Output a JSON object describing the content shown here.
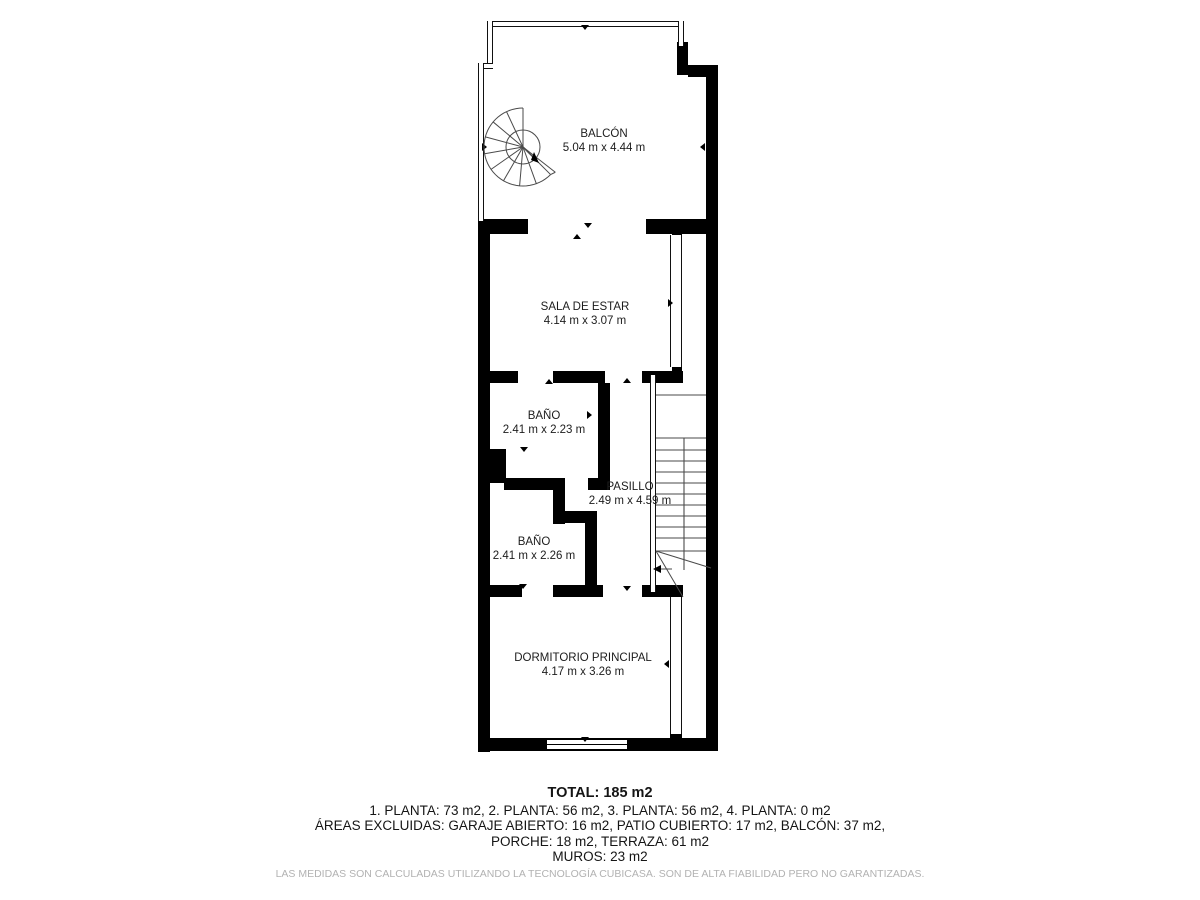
{
  "colors": {
    "wall": "#000000",
    "line": "#4a4a4a",
    "text": "#1c1c1c",
    "muted": "#b2b2b2"
  },
  "rooms": [
    {
      "id": "balcon",
      "name": "BALCÓN",
      "dims": "5.04 m x 4.44 m",
      "x": 604,
      "y": 128
    },
    {
      "id": "sala-de-estar",
      "name": "SALA DE ESTAR",
      "dims": "4.14 m x 3.07 m",
      "x": 585,
      "y": 301
    },
    {
      "id": "bano-1",
      "name": "BAÑO",
      "dims": "2.41 m x 2.23 m",
      "x": 544,
      "y": 410
    },
    {
      "id": "pasillo",
      "name": "PASILLO",
      "dims": "2.49 m x 4.59 m",
      "x": 630,
      "y": 481
    },
    {
      "id": "bano-2",
      "name": "BAÑO",
      "dims": "2.41 m x 2.26 m",
      "x": 534,
      "y": 536
    },
    {
      "id": "dormitorio-principal",
      "name": "DORMITORIO PRINCIPAL",
      "dims": "4.17 m x 3.26 m",
      "x": 583,
      "y": 652
    }
  ],
  "summary": {
    "total": "TOTAL: 185 m2",
    "plantas": "1. PLANTA: 73 m2, 2. PLANTA: 56 m2, 3. PLANTA: 56 m2, 4. PLANTA: 0 m2",
    "excluidas": "ÁREAS EXCLUIDAS: GARAJE ABIERTO: 16 m2, PATIO CUBIERTO: 17 m2, BALCÓN: 37 m2,",
    "porche": "PORCHE: 18 m2, TERRAZA: 61 m2",
    "muros": "MUROS: 23 m2"
  },
  "disclaimer": "LAS MEDIDAS SON CALCULADAS UTILIZANDO LA TECNOLOGÍA CUBICASA. SON DE ALTA FIABILIDAD PERO NO GARANTIZADAS.",
  "floorplan": {
    "thick_walls": [
      [
        478,
        219,
        12,
        533
      ],
      [
        478,
        738,
        240,
        13
      ],
      [
        706,
        68,
        12,
        683
      ],
      [
        688,
        65,
        30,
        12
      ],
      [
        677,
        42,
        11,
        33
      ],
      [
        478,
        219,
        50,
        15
      ],
      [
        646,
        219,
        60,
        15
      ],
      [
        672,
        231,
        10,
        9
      ],
      [
        484,
        371,
        34,
        12
      ],
      [
        553,
        371,
        52,
        12
      ],
      [
        642,
        371,
        41,
        12
      ],
      [
        672,
        361,
        10,
        12
      ],
      [
        598,
        383,
        12,
        107
      ],
      [
        588,
        478,
        22,
        12
      ],
      [
        481,
        449,
        25,
        34
      ],
      [
        504,
        478,
        61,
        12
      ],
      [
        553,
        478,
        12,
        46
      ],
      [
        555,
        511,
        42,
        12
      ],
      [
        585,
        511,
        12,
        86
      ],
      [
        484,
        585,
        38,
        12
      ],
      [
        553,
        585,
        50,
        12
      ],
      [
        642,
        585,
        41,
        12
      ],
      [
        670,
        731,
        12,
        9
      ]
    ],
    "rails": [
      [
        487,
        21,
        197,
        6
      ],
      [
        487,
        21,
        6,
        48
      ],
      [
        478,
        63,
        15,
        6
      ],
      [
        478,
        63,
        6,
        158
      ],
      [
        678,
        21,
        6,
        25
      ]
    ],
    "partitions": [
      [
        670,
        235,
        12,
        132
      ],
      [
        670,
        597,
        12,
        137
      ],
      [
        650,
        375,
        6,
        217
      ]
    ],
    "window": [
      546,
      739,
      82,
      11
    ],
    "stairs": {
      "x1": 656,
      "x2": 706,
      "mid_line": [
        684,
        438,
        684,
        570
      ],
      "treads_y": [
        395,
        438,
        450,
        461,
        472,
        483,
        494,
        505,
        516,
        527,
        538,
        551
      ],
      "diagonals": [
        [
          656,
          551,
          711,
          568
        ],
        [
          656,
          551,
          683,
          597
        ],
        [
          672,
          569,
          659,
          569
        ]
      ],
      "arrow_head": "653,569 661,565 661,573"
    },
    "spiral": {
      "cx": 523,
      "cy": 147,
      "r": 39,
      "r_inner": 17,
      "start_deg": 90,
      "end_deg": 315,
      "spoke_step": 25,
      "chord_deg": 322,
      "chord_r": 41,
      "arrow_line": [
        523,
        147,
        534,
        158
      ],
      "arrow_head": "539,163 531,160 534,152"
    },
    "markers": [
      [
        585,
        29,
        "down"
      ],
      [
        588,
        227,
        "down"
      ],
      [
        577,
        238,
        "up"
      ],
      [
        704,
        147,
        "left"
      ],
      [
        486,
        147,
        "right"
      ],
      [
        486,
        303,
        "right"
      ],
      [
        672,
        303,
        "right"
      ],
      [
        549,
        383,
        "up"
      ],
      [
        627,
        382,
        "up"
      ],
      [
        602,
        388,
        "down"
      ],
      [
        591,
        415,
        "right"
      ],
      [
        486,
        417,
        "right"
      ],
      [
        524,
        451,
        "down"
      ],
      [
        521,
        489,
        "up"
      ],
      [
        592,
        557,
        "right"
      ],
      [
        483,
        553,
        "right"
      ],
      [
        712,
        388,
        "left"
      ],
      [
        523,
        588,
        "down"
      ],
      [
        627,
        590,
        "down"
      ],
      [
        487,
        664,
        "right"
      ],
      [
        668,
        664,
        "left"
      ],
      [
        585,
        741,
        "down"
      ]
    ]
  }
}
